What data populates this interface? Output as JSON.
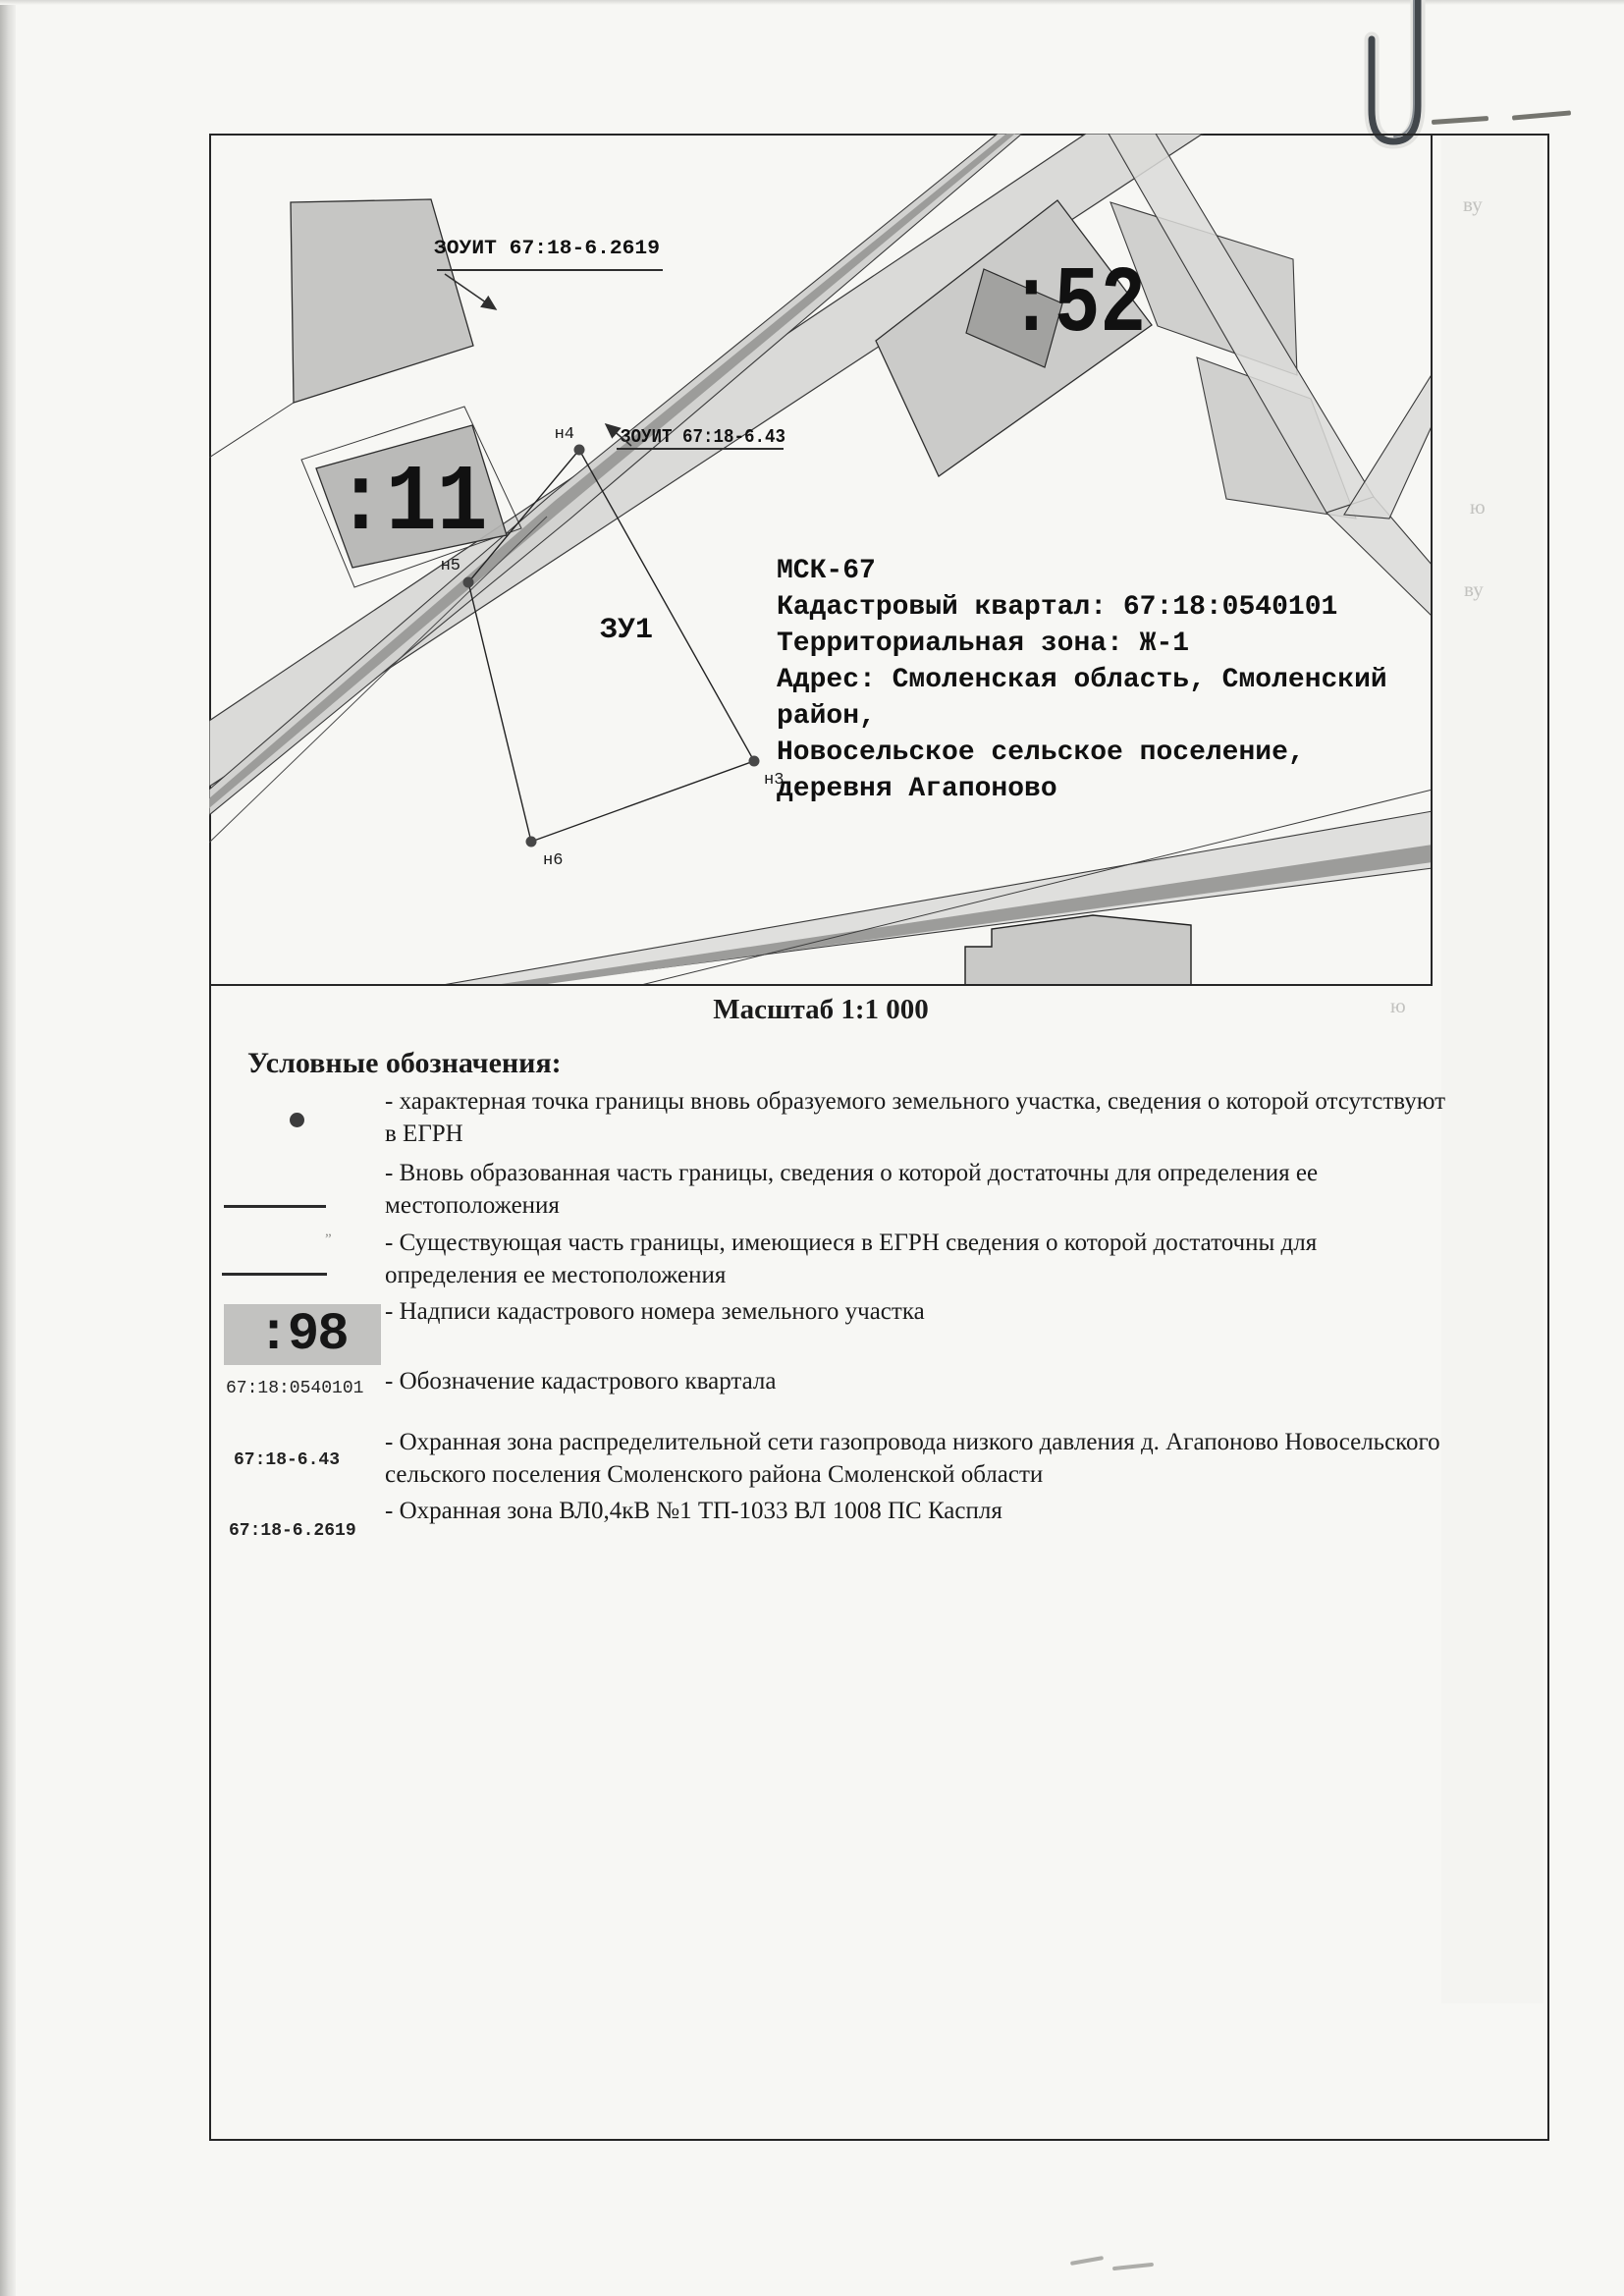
{
  "page": {
    "scale_caption": "Масштаб 1:1 000"
  },
  "map": {
    "zouit_label_1": "ЗОУИТ 67:18-6.2619",
    "zouit_label_2": "ЗОУИТ 67:18-6.43",
    "parcel_label_11": ":11",
    "parcel_label_52": ":52",
    "parcel_label_zu1": "ЗУ1",
    "point_labels": {
      "n3": "н3",
      "n4": "н4",
      "n5": "н5",
      "n6": "н6"
    },
    "info_lines": [
      "МСК-67",
      "Кадастровый квартал: 67:18:0540101",
      "Территориальная зона: Ж-1",
      "Адрес: Смоленская область, Смоленский",
      "район,",
      "Новосельское сельское поселение,",
      "деревня Агапоново"
    ]
  },
  "legend": {
    "title": "Условные обозначения:",
    "items": [
      {
        "symbol": "point-dot",
        "line1": "- характерная точка границы вновь образуемого земельного участка, сведения о которой отсутствуют",
        "line2": "в ЕГРН"
      },
      {
        "symbol": "line-new",
        "line1": "- Вновь образованная часть границы, сведения о которой достаточны для определения ее",
        "line2": "местоположения"
      },
      {
        "symbol": "line-existing",
        "line1": "- Существующая часть границы, имеющиеся в ЕГРН сведения о которой достаточны для",
        "line2": "определения ее местоположения"
      },
      {
        "symbol_label": ":98",
        "line1": "- Надписи кадастрового номера земельного участка"
      },
      {
        "symbol_label": "67:18:0540101",
        "line1": "- Обозначение кадастрового квартала"
      },
      {
        "symbol_label": "67:18-6.43",
        "line1": "- Охранная зона распределительной сети газопровода низкого давления д. Агапоново Новосельского",
        "line2": "сельского поселения Смоленского района Смоленской области"
      },
      {
        "symbol_label": "67:18-6.2619",
        "line1": "- Охранная зона ВЛ0,4кВ №1 ТП-1033 ВЛ 1008 ПС Каспля"
      }
    ]
  },
  "ghost_marks": {
    "m1": "ву",
    "m2": "ю",
    "m3": "ву",
    "m4": "ю"
  },
  "colors": {
    "road": "#dadad8",
    "road_core": "#9c9c9a",
    "parcel": "#c8c8c6",
    "parcel_dark": "#b4b4b2",
    "building": "#a2a2a0",
    "line": "#2f2f2f",
    "paper": "#f7f7f4"
  }
}
